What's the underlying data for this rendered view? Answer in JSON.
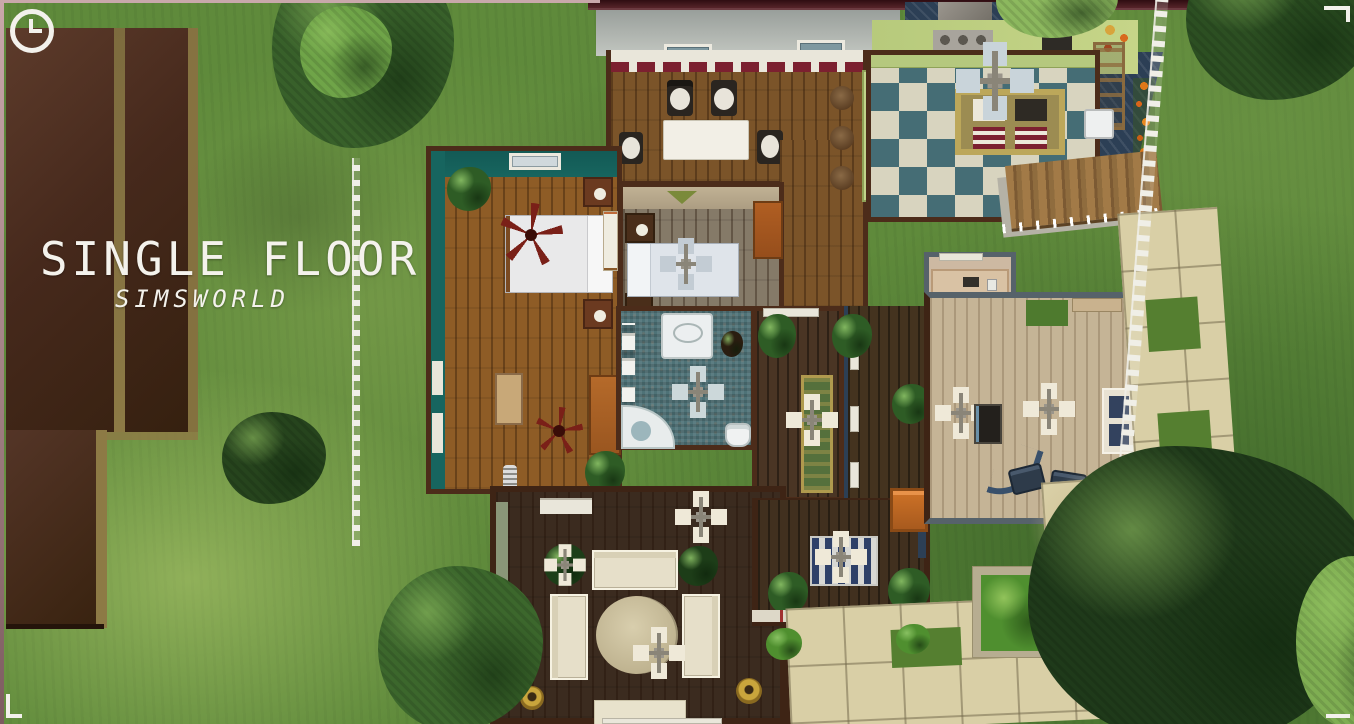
{
  "overlay": {
    "title": "SINGLE FLOOR",
    "subtitle": "SIMSWORLD"
  },
  "hud": {
    "clock_icon": "clock-icon"
  },
  "colors": {
    "frame_mauve": "#c9a8ab",
    "roof_brown": "#46291c",
    "roof_stripe_khaki": "#8d7a45",
    "fascia_maroon": "#3a1016",
    "grass_green": "#5f8a3b",
    "wall_brown": "#4c2c1a",
    "teal_wall": "#17655f",
    "navy_blue": "#2c3f55",
    "checker_teal": "#456d75",
    "checker_cream": "#d8d4bf",
    "counter_green": "#b5c87e",
    "wood_medium": "#7b5429",
    "wood_dark": "#3b2b1f",
    "wood_light": "#c5b496",
    "paver_beige": "#d9cfa6",
    "fence_white": "#efefe6",
    "title_text": "#f4f2ec"
  }
}
